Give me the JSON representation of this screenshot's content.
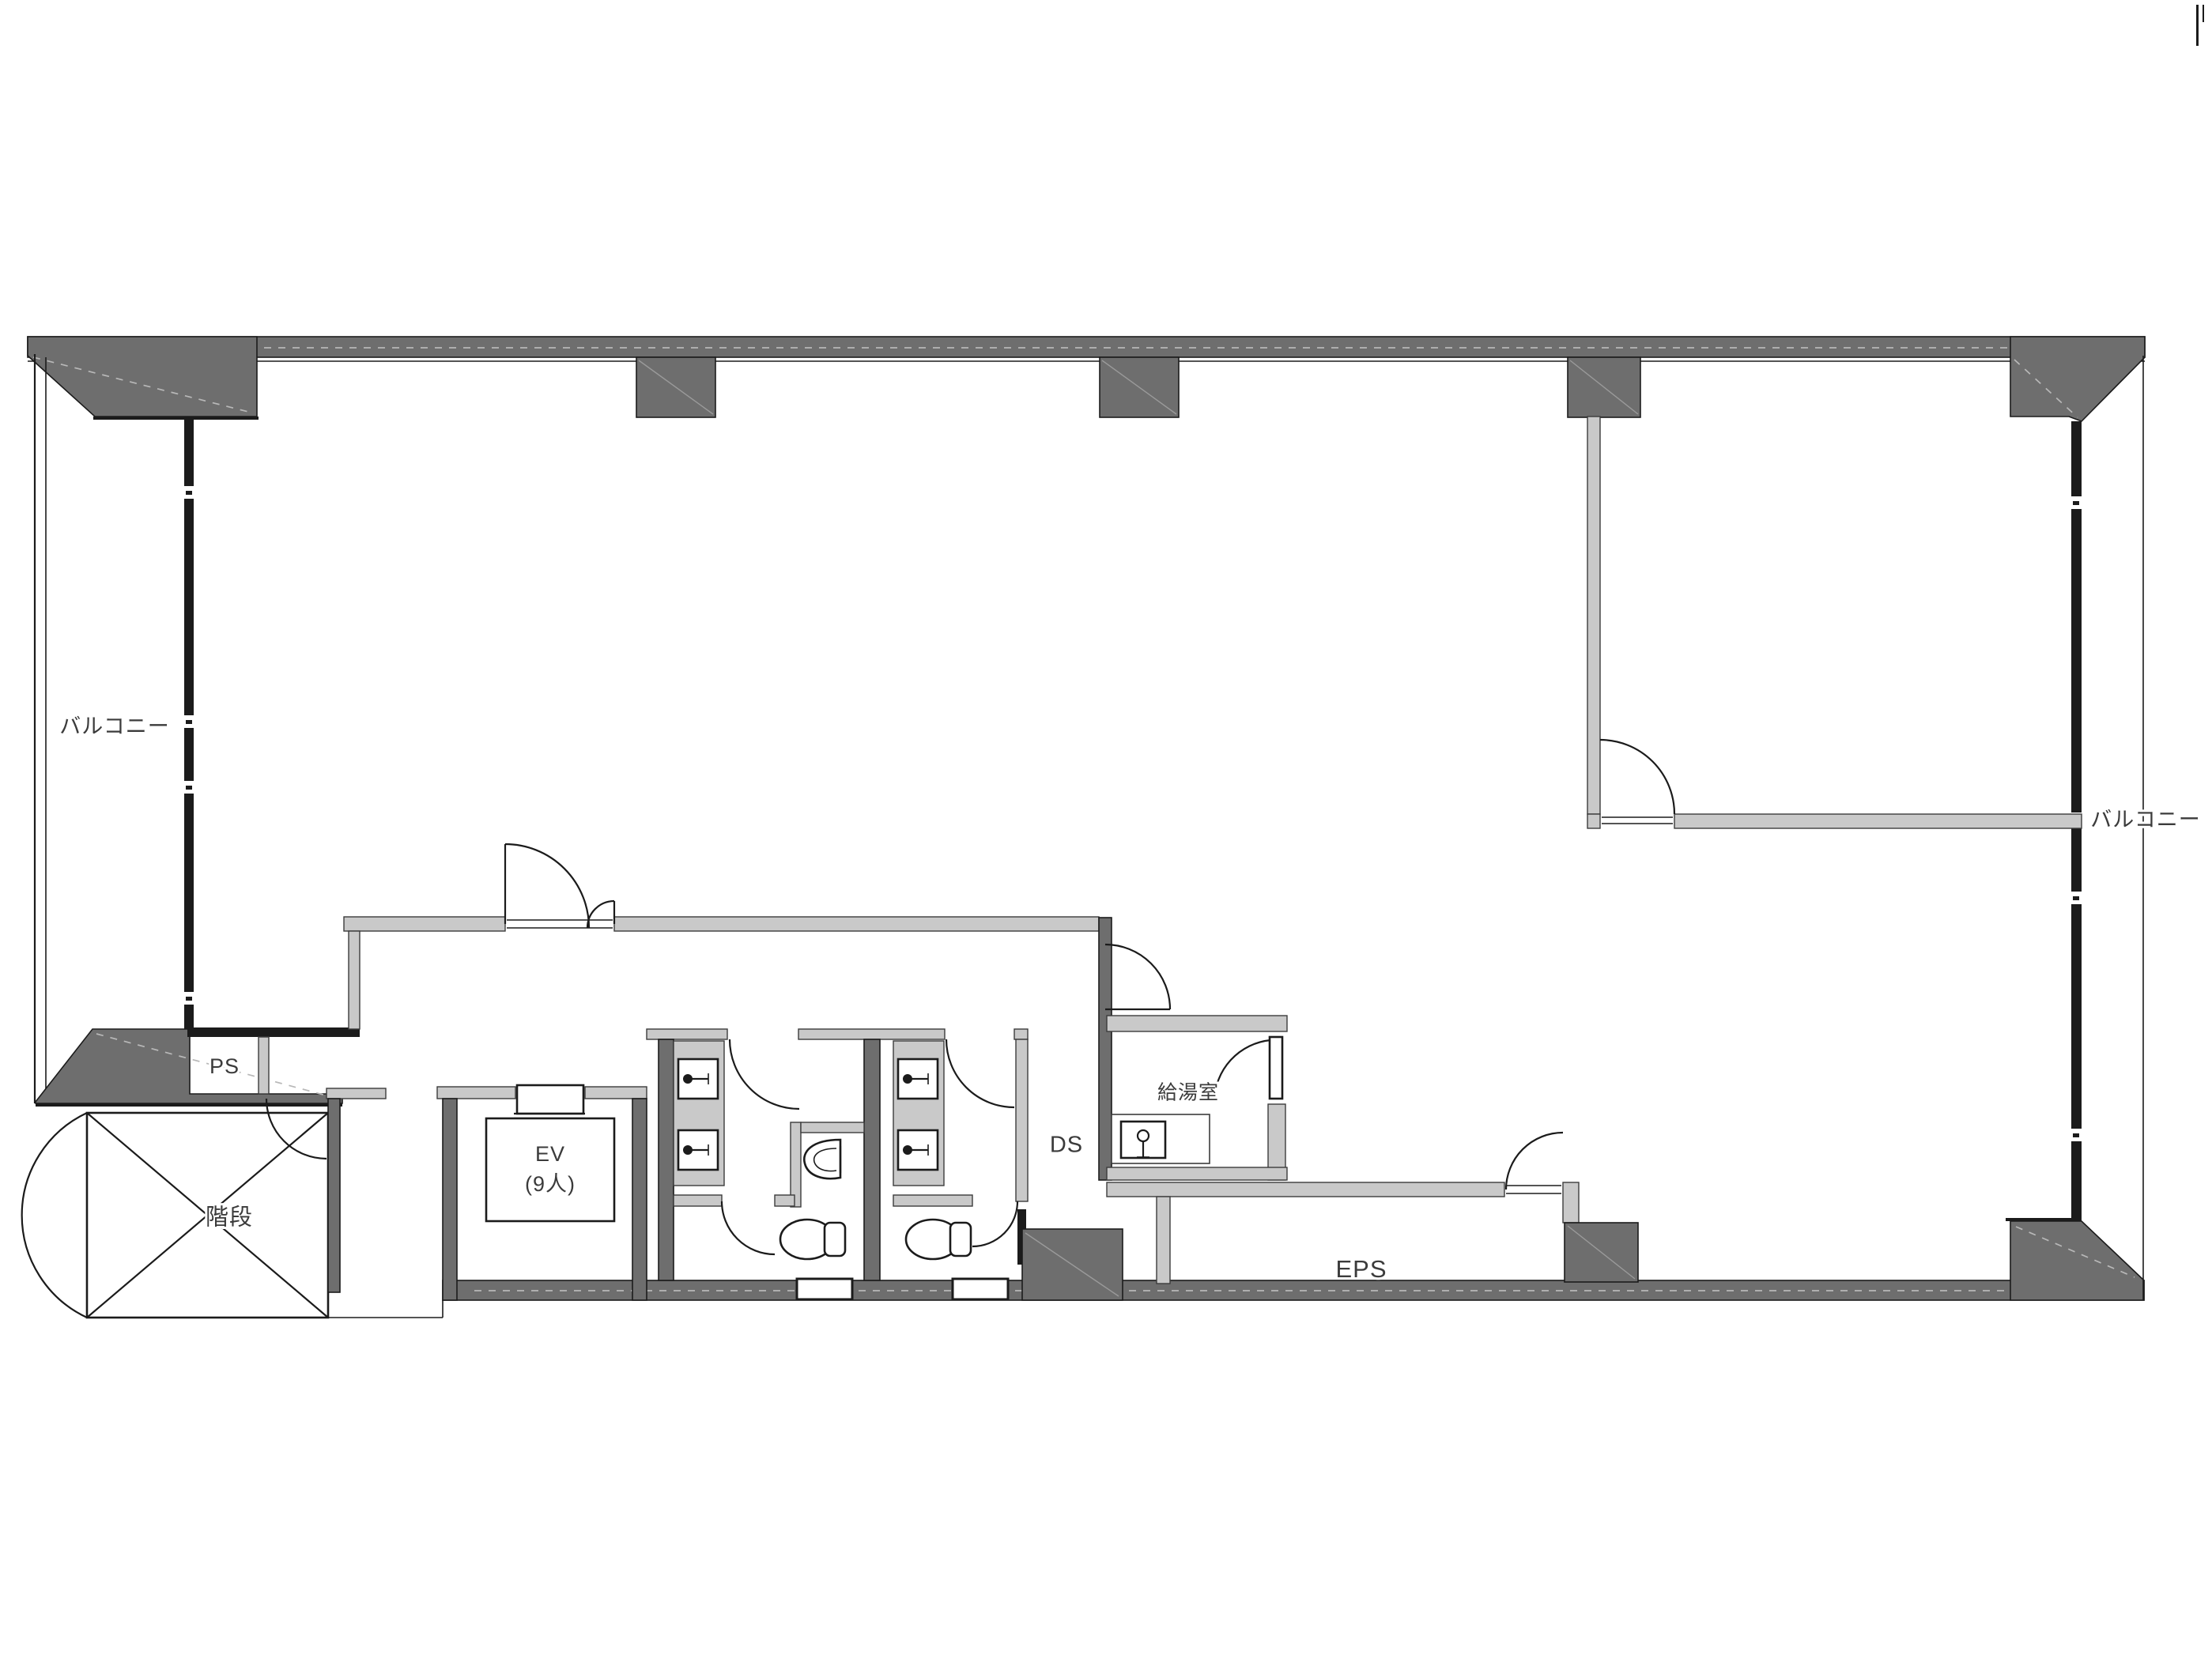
{
  "labels": {
    "balcony_left": "バルコニー",
    "balcony_right": "バルコニー",
    "ps": "PS",
    "stairs": "階段",
    "elevator_line1": "EV",
    "elevator_line2": "(9人)",
    "ds": "DS",
    "kitchenette": "給湯室",
    "eps": "EPS"
  },
  "colors": {
    "wall-dark": "#6e6e6e",
    "wall-light": "#c9c9c9",
    "line": "#1b1b1b",
    "edge": "#3c3c3c",
    "hatch": "#b8b8b8",
    "hatch2": "#9a9a9a",
    "text": "#3b3b3b",
    "bg": "#ffffff"
  }
}
